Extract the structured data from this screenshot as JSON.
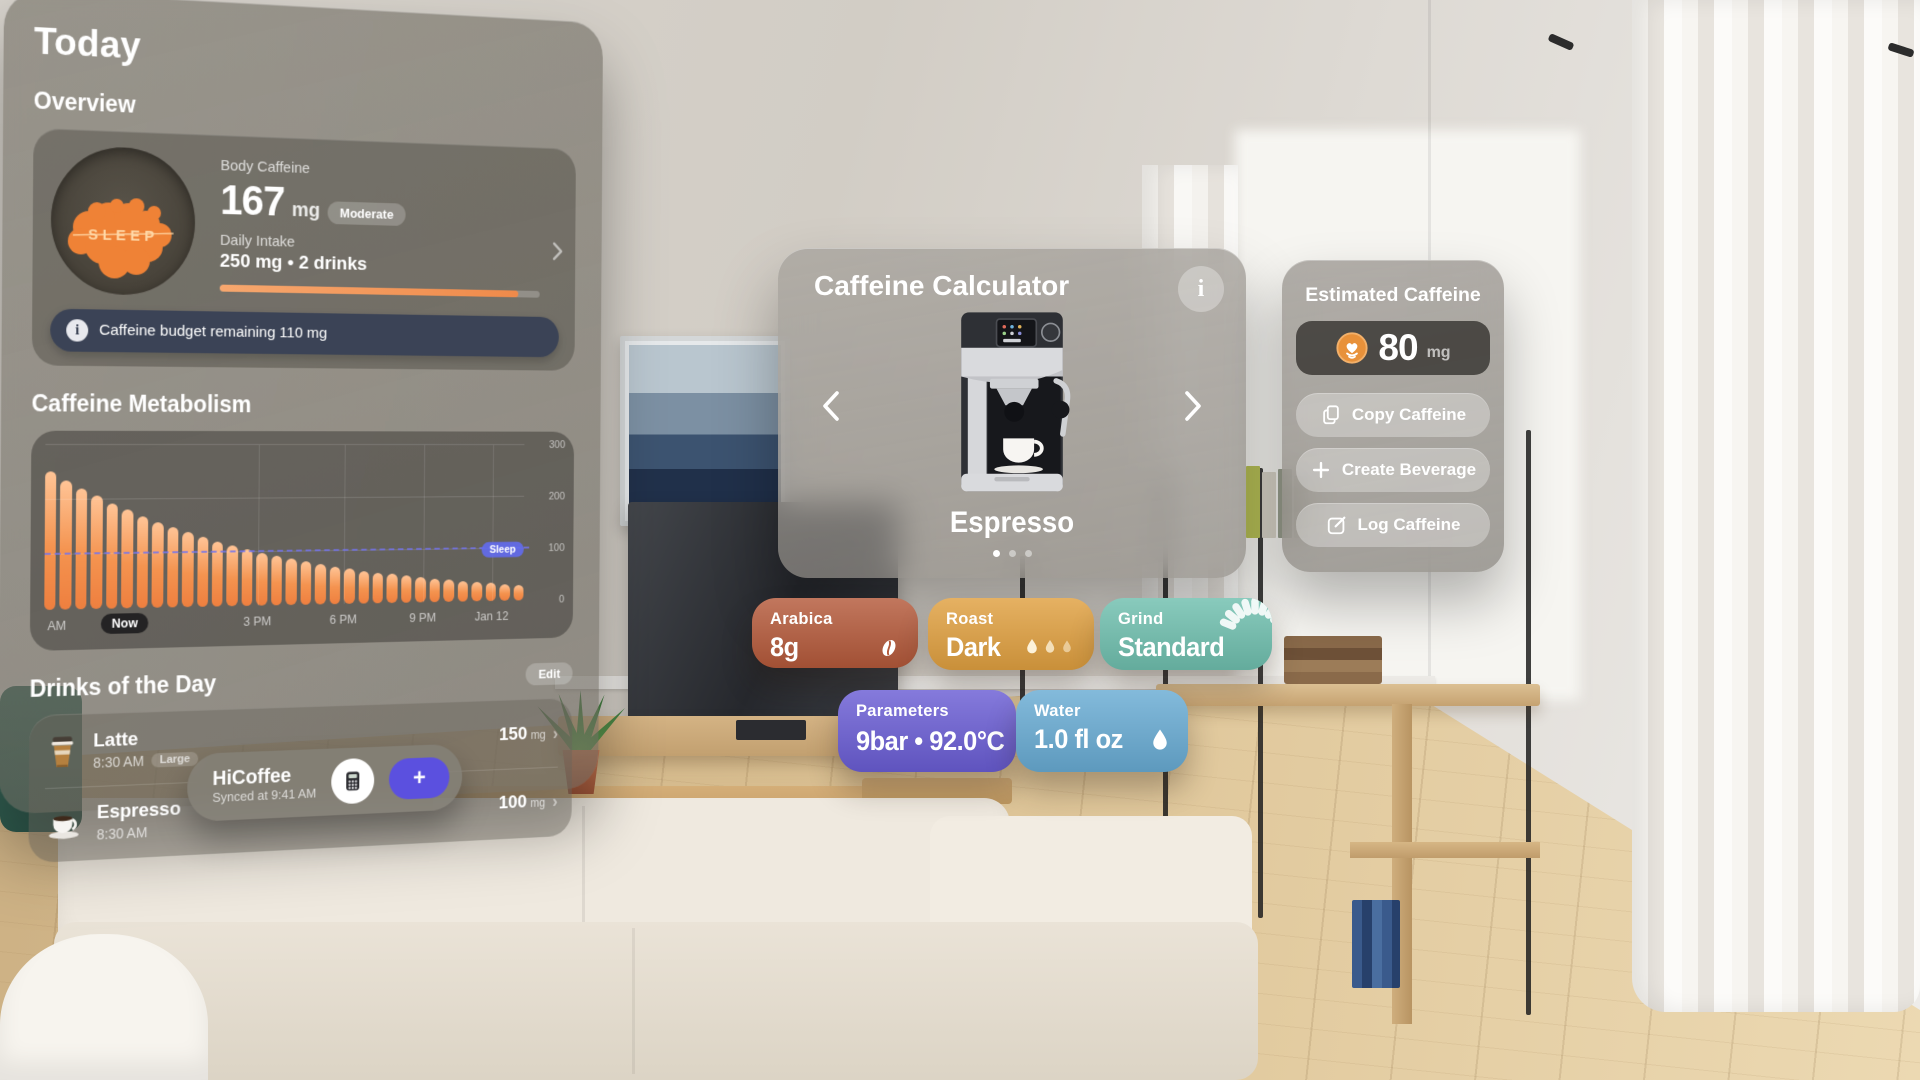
{
  "today_panel": {
    "title": "Today",
    "overview": {
      "heading": "Overview",
      "sleep_label": "SLEEP",
      "body_caffeine_label": "Body Caffeine",
      "body_caffeine_value": "167",
      "body_caffeine_unit": "mg",
      "level_badge": "Moderate",
      "daily_intake_label": "Daily Intake",
      "daily_intake_value": "250 mg • 2 drinks",
      "progress_pct": 93,
      "budget_note": "Caffeine budget remaining 110 mg"
    },
    "metabolism_heading": "Caffeine Metabolism",
    "drinks": {
      "heading": "Drinks of the Day",
      "edit_label": "Edit",
      "items": [
        {
          "name": "Latte",
          "time": "8:30 AM",
          "size_badge": "Large",
          "amount": "150",
          "unit": "mg",
          "icon": "latte-cup"
        },
        {
          "name": "Espresso",
          "time": "8:30 AM",
          "size_badge": "",
          "amount": "100",
          "unit": "mg",
          "icon": "espresso-cup"
        }
      ]
    },
    "footer": {
      "app_name": "HiCoffee",
      "synced": "Synced at 9:41 AM",
      "add_label": "+"
    }
  },
  "chart_data": {
    "type": "bar",
    "title": "Caffeine Metabolism",
    "ylabel": "mg",
    "ylim": [
      0,
      300
    ],
    "grid": true,
    "bar_color": "#f08a4e",
    "values": [
      252,
      236,
      221,
      207,
      193,
      181,
      169,
      158,
      148,
      139,
      130,
      121,
      113,
      106,
      99,
      93,
      87,
      81,
      76,
      71,
      67,
      62,
      58,
      55,
      51,
      48,
      45,
      42,
      39,
      37,
      35,
      32,
      30
    ],
    "y_ticks": [
      {
        "label": "300",
        "value": 300
      },
      {
        "label": "200",
        "value": 200
      },
      {
        "label": "100",
        "value": 100
      },
      {
        "label": "0",
        "value": 0
      }
    ],
    "x_ticks": [
      {
        "label": "AM",
        "pct": 2.5,
        "badge": false
      },
      {
        "label": "Now",
        "pct": 16,
        "badge": true
      },
      {
        "label": "3 PM",
        "pct": 43,
        "badge": false
      },
      {
        "label": "6 PM",
        "pct": 61,
        "badge": false
      },
      {
        "label": "9 PM",
        "pct": 78,
        "badge": false
      },
      {
        "label": "Jan 12",
        "pct": 93,
        "badge": false
      }
    ],
    "sleep_threshold": {
      "label": "Sleep",
      "value": 100,
      "color": "#626cee"
    }
  },
  "calculator_panel": {
    "title": "Caffeine Calculator",
    "info_label": "i",
    "carousel": {
      "current_item": "Espresso",
      "prev": "‹",
      "next": "›",
      "dot_count": 3,
      "active_dot": 0
    }
  },
  "estimate_panel": {
    "title": "Estimated Caffeine",
    "value": "80",
    "unit": "mg",
    "icon": "latte-art",
    "buttons": [
      {
        "label": "Copy Caffeine",
        "icon": "copy"
      },
      {
        "label": "Create Beverage",
        "icon": "plus"
      },
      {
        "label": "Log Caffeine",
        "icon": "compose"
      }
    ]
  },
  "chips": [
    {
      "id": "arabica",
      "label": "Arabica",
      "value": "8g",
      "color": "#b4593a",
      "icon": "coffee-bean",
      "row": 1
    },
    {
      "id": "roast",
      "label": "Roast",
      "value": "Dark",
      "color": "#e0a040",
      "icon": "roast-level",
      "row": 1
    },
    {
      "id": "grind",
      "label": "Grind",
      "value": "Standard",
      "color": "#6fbfae",
      "icon": "burr-grinder",
      "row": 1
    },
    {
      "id": "parameters",
      "label": "Parameters",
      "value": "9bar • 92.0°C",
      "color": "#6a5dd4",
      "icon": "thermometer",
      "row": 2
    },
    {
      "id": "water",
      "label": "1.0 fl oz",
      "value": "1.0 fl oz",
      "color": "#68abd3",
      "icon": "water-drop",
      "row": 2,
      "label_text": "Water"
    }
  ]
}
